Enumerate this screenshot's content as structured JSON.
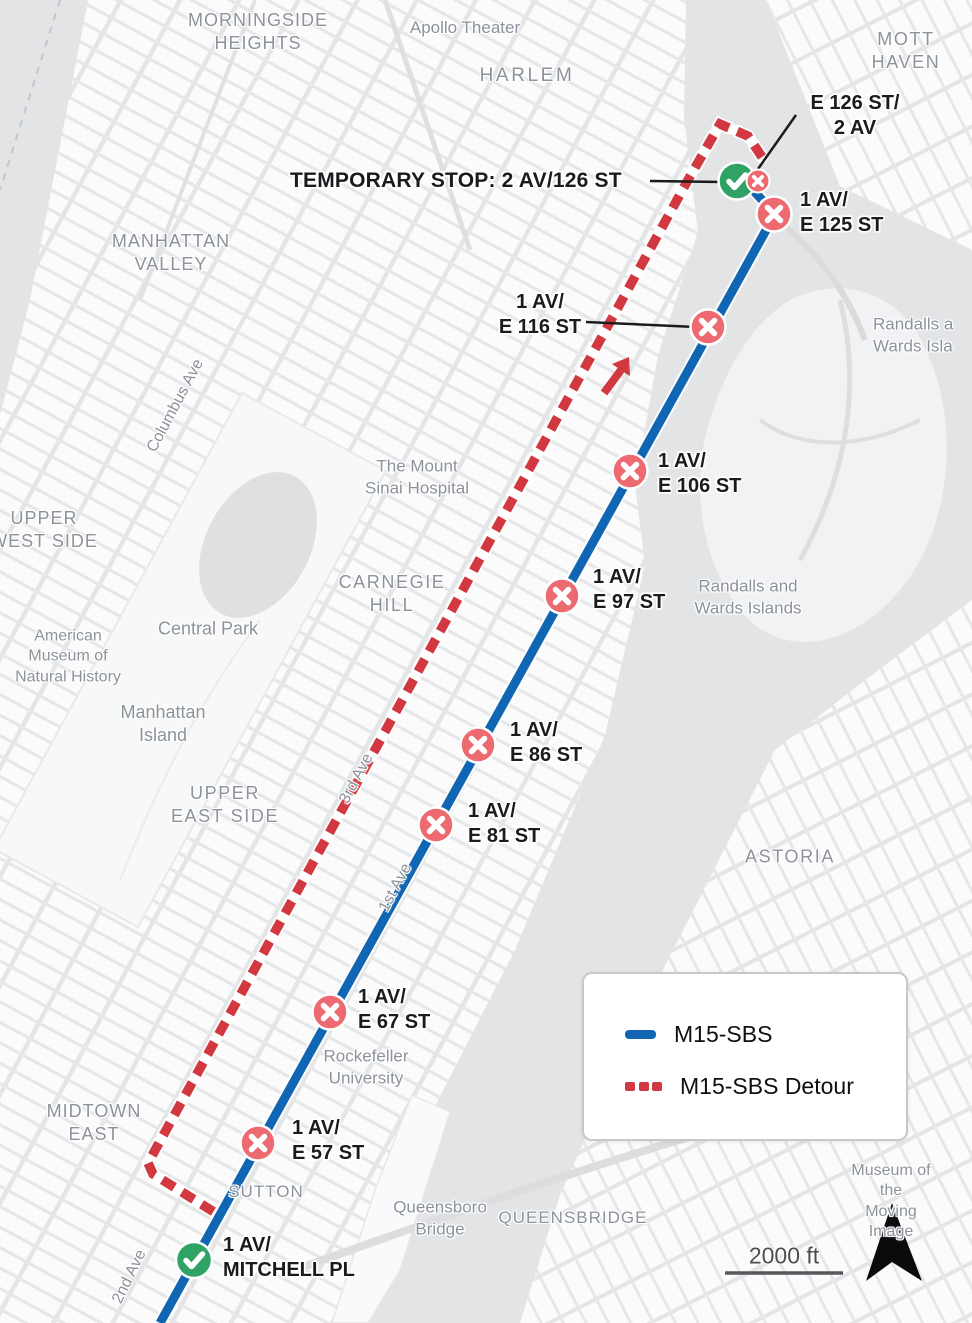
{
  "labels": {
    "morningside": "MORNINGSIDE\nHEIGHTS",
    "apollo": "Apollo Theater",
    "harlem": "HARLEM",
    "mott_haven": "MOTT HAVEN",
    "manhattan_valley": "MANHATTAN\nVALLEY",
    "columbus_ave": "Columbus Ave",
    "upper_west_side": "UPPER\nWEST SIDE",
    "randalls_edge": "Randalls a\nWards Isla",
    "mount_sinai": "The Mount\nSinai Hospital",
    "carnegie_hill": "CARNEGIE\nHILL",
    "central_park": "Central Park",
    "amnh": "American\nMuseum of\nNatural History",
    "manhattan_island": "Manhattan\nIsland",
    "randalls_wards": "Randalls and\nWards Islands",
    "upper_east_side": "UPPER\nEAST SIDE",
    "third_ave": "3rd Ave",
    "first_ave": "1st Ave",
    "astoria": "ASTORIA",
    "rockefeller": "Rockefeller\nUniversity",
    "midtown_east": "MIDTOWN\nEAST",
    "sutton": "SUTTON",
    "queensboro": "Queensboro\nBridge",
    "queensbridge": "QUEENSBRIDGE",
    "museum_moving_image": "Museum of the\nMoving Image",
    "second_ave": "2nd Ave"
  },
  "stops": {
    "temp_126": {
      "label": "TEMPORARY STOP: 2 AV/126 ST",
      "status": "temporary-open"
    },
    "e126_2av": {
      "label": "E 126 ST/\n2 AV",
      "status": "closed"
    },
    "e125": {
      "label": "1 AV/\nE 125 ST",
      "status": "closed"
    },
    "e116": {
      "label": "1 AV/\nE 116 ST",
      "status": "closed"
    },
    "e106": {
      "label": "1 AV/\nE 106 ST",
      "status": "closed"
    },
    "e97": {
      "label": "1 AV/\nE 97 ST",
      "status": "closed"
    },
    "e86": {
      "label": "1 AV/\nE 86 ST",
      "status": "closed"
    },
    "e81": {
      "label": "1 AV/\nE 81 ST",
      "status": "closed"
    },
    "e67": {
      "label": "1 AV/\nE 67 ST",
      "status": "closed"
    },
    "e57": {
      "label": "1 AV/\nE 57 ST",
      "status": "closed"
    },
    "mitchell": {
      "label": "1 AV/\nMITCHELL PL",
      "status": "open"
    }
  },
  "legend": {
    "route_label": "M15-SBS",
    "detour_label": "M15-SBS Detour"
  },
  "scale": {
    "label": "2000 ft"
  },
  "colors": {
    "route_blue": "#1066B2",
    "detour_red": "#D2383F",
    "stop_closed_red": "#EC6A70",
    "stop_open_green": "#2FA366"
  }
}
